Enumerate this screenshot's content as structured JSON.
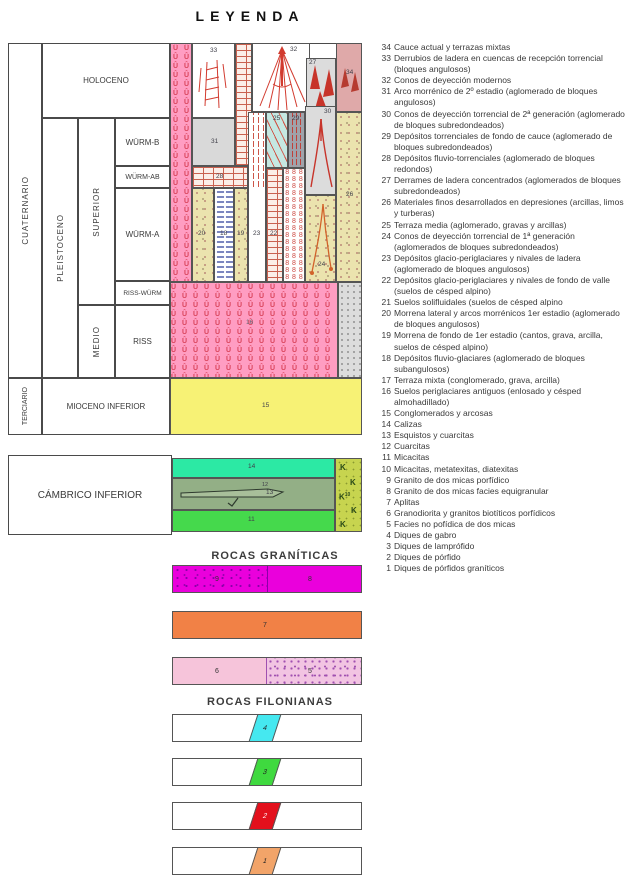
{
  "title": "LEYENDA",
  "sections": {
    "graniticas": "ROCAS GRANÍTICAS",
    "filonianas": "ROCAS FILONIANAS"
  },
  "strat": {
    "cuaternario": "CUATERNARIO",
    "terciario": "TERCIARIO",
    "holoceno": "HOLOCENO",
    "pleistoceno": "PLEISTOCENO",
    "superior": "SUPERIOR",
    "medio": "MEDIO",
    "wurm_b": "WÜRM-B",
    "wurm_ab": "WÜRM-AB",
    "wurm_a": "WÜRM-A",
    "riss_wurm": "RISS-WÜRM",
    "riss": "RISS",
    "mioceno_inferior": "MIOCENO INFERIOR",
    "cambrico_inferior": "CÁMBRICO INFERIOR"
  },
  "units": {
    "u34": "34",
    "u33": "33",
    "u32": "32",
    "u31": "31",
    "u30": "30",
    "u29": "29",
    "u28": "28",
    "u27": "27",
    "u26": "26",
    "u25": "25",
    "u24": "24",
    "u23": "23",
    "u22": "22",
    "u20": "20",
    "u19": "19",
    "u18": "18",
    "u16": "16",
    "u15": "15",
    "u14": "14",
    "u13": "13",
    "u12": "12",
    "u11": "11",
    "u10": "10",
    "u9": "9",
    "u8": "8",
    "u7": "7",
    "u6": "6",
    "u5": "5",
    "u4": "4",
    "u3": "3",
    "u2": "2",
    "u1": "1"
  },
  "patterns": {
    "u_symbol": "Û",
    "eight_symbol": "8",
    "k_symbol": "K"
  },
  "colors": {
    "periglacial_pink": "#ff9dc2",
    "soil_symbol_red": "#d9435a",
    "miocene_yellow": "#f7f275",
    "terrace_34_rose": "#dfa9a9",
    "grey_cell": "#dcdcdc",
    "dark_grey_cell": "#9fa3ab",
    "terrace_media_cyan": "#c5e8e2",
    "tan_deposit": "#ebe3ae",
    "cambrian_limestone_green": "#2ce9a4",
    "cambrian_schist_green": "#93af86",
    "cambrian_micacite_green": "#45d94c",
    "cambrian_metatexite_olive": "#c7d44f",
    "granite_magenta": "#ea00dc",
    "granite_orange": "#f18146",
    "granite_pink": "#f6c4da",
    "dike_cyan": "#45e8f0",
    "dike_green": "#3fd93f",
    "dike_red": "#e3101c",
    "dike_tan": "#f2a469"
  },
  "legend_items": [
    {
      "num": "34",
      "text": "Cauce actual y terrazas mixtas"
    },
    {
      "num": "33",
      "text": "Derrubios de ladera en cuencas de recepción torrencial (bloques angulosos)"
    },
    {
      "num": "32",
      "text": "Conos de deyección modernos"
    },
    {
      "num": "31",
      "text": "Arco morrénico de 2º estadio (aglomerado de bloques angulosos)"
    },
    {
      "num": "30",
      "text": "Conos de deyección torrencial de 2ª generación (aglomerado de bloques subredondeados)"
    },
    {
      "num": "29",
      "text": "Depósitos torrenciales de fondo de cauce (aglomerado de bloques subredondeados)"
    },
    {
      "num": "28",
      "text": "Depósitos fluvio-torrenciales (aglomerado de bloques redondos)"
    },
    {
      "num": "27",
      "text": "Derrames de ladera concentrados (aglomerados de bloques subredondeados)"
    },
    {
      "num": "26",
      "text": "Materiales finos desarrollados en depresiones (arcillas, limos y turberas)"
    },
    {
      "num": "25",
      "text": "Terraza media (aglomerado, gravas y arcillas)"
    },
    {
      "num": "24",
      "text": "Conos de deyección torrencial de 1ª generación (aglomerados de bloques subredondeados)"
    },
    {
      "num": "23",
      "text": "Depósitos glacio-periglaciares y nivales de ladera (aglomerado de bloques angulosos)"
    },
    {
      "num": "22",
      "text": "Depósitos glacio-periglaciares y nivales de fondo de valle (suelos de césped alpino)"
    },
    {
      "num": "21",
      "text": "Suelos solifluidales (suelos de césped alpino"
    },
    {
      "num": "20",
      "text": "Morrena lateral y arcos morrénicos 1er estadio (aglomerado de bloques angulosos)"
    },
    {
      "num": "19",
      "text": "Morrena de fondo de 1er estadio (cantos, grava, arcilla, suelos de césped alpino)"
    },
    {
      "num": "18",
      "text": "Depósitos fluvio-glaciares (aglomerado de bloques subangulosos)"
    },
    {
      "num": "17",
      "text": "Terraza mixta (conglomerado, grava, arcilla)"
    },
    {
      "num": "16",
      "text": "Suelos periglaciares antiguos (enlosado y césped almohadillado)"
    },
    {
      "num": "15",
      "text": "Conglomerados y arcosas"
    },
    {
      "num": "14",
      "text": "Calizas"
    },
    {
      "num": "13",
      "text": "Esquistos y cuarcitas"
    },
    {
      "num": "12",
      "text": "Cuarcitas"
    },
    {
      "num": "11",
      "text": "Micacitas"
    },
    {
      "num": "10",
      "text": "Micacitas, metatexitas, diatexitas"
    },
    {
      "num": "9",
      "text": "Granito de dos micas porfídico"
    },
    {
      "num": "8",
      "text": "Granito de dos micas facies equigranular"
    },
    {
      "num": "7",
      "text": "Aplitas"
    },
    {
      "num": "6",
      "text": "Granodiorita y granitos biotíticos porfídicos"
    },
    {
      "num": "5",
      "text": "Facies no pofídica de dos micas"
    },
    {
      "num": "4",
      "text": "Diques de gabro"
    },
    {
      "num": "3",
      "text": "Diques de lamprófido"
    },
    {
      "num": "2",
      "text": "Diques de pórfido"
    },
    {
      "num": "1",
      "text": "Diques de pórfidos graníticos"
    }
  ]
}
